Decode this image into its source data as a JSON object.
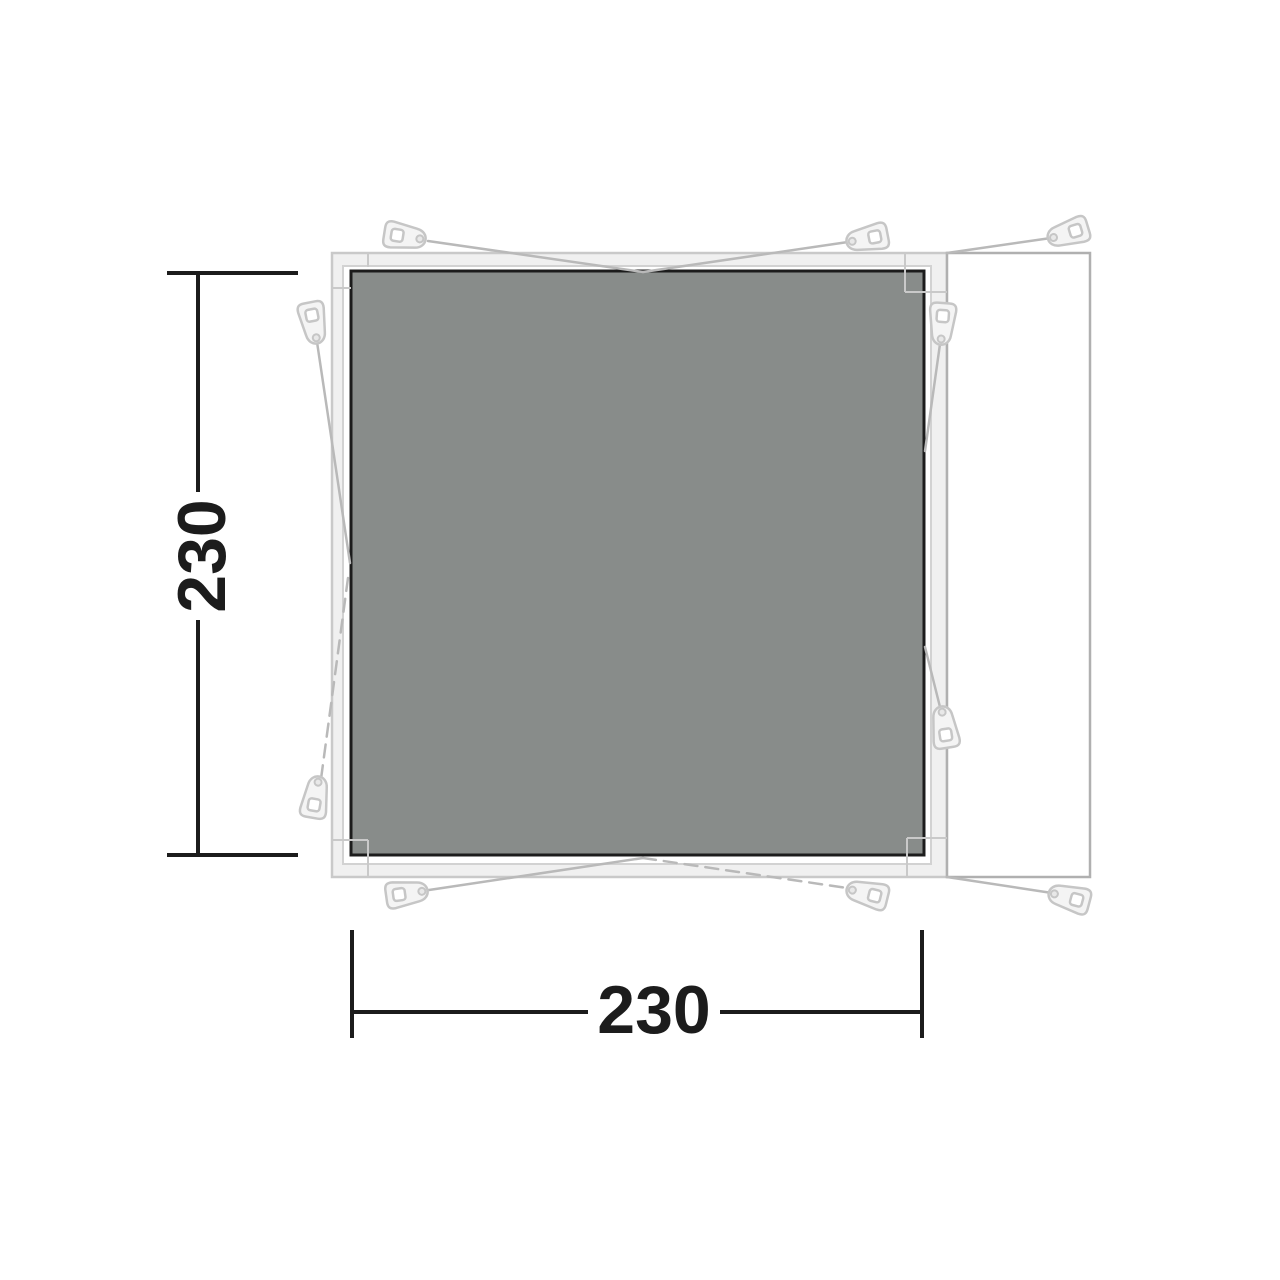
{
  "diagram": {
    "type": "tent-footprint-floorplan",
    "dimensions": {
      "height_label": "230",
      "width_label": "230"
    },
    "colors": {
      "background": "#ffffff",
      "groundsheet_fill": "#888c8a",
      "groundsheet_border": "#1c1c1c",
      "outer_tent_stroke": "#c9c9c9",
      "outer_tent_fill": "#f0f0f0",
      "inner_tent_stroke": "#d2d2d2",
      "inner_tent_fill": "#ffffff",
      "extension_stroke": "#b0b0b0",
      "extension_fill": "#ffffff",
      "guy_line": "#b9b9b9",
      "peg_stroke": "#c6c6c6",
      "peg_fill": "#f4f4f4",
      "dimension_color": "#1c1c1c"
    },
    "shapes": {
      "outer_tent": {
        "x": 332,
        "y": 253,
        "w": 615,
        "h": 624
      },
      "inner_tent": {
        "x": 343,
        "y": 266,
        "w": 588,
        "h": 598
      },
      "groundsheet": {
        "x": 351,
        "y": 271,
        "w": 573,
        "h": 584
      },
      "side_extension": {
        "x": 947,
        "y": 253,
        "w": 143,
        "h": 624
      }
    },
    "seam_lines": [
      [
        368,
        253,
        368,
        267
      ],
      [
        332,
        288,
        351,
        288
      ],
      [
        905,
        253,
        905,
        292
      ],
      [
        905,
        292,
        947,
        292
      ],
      [
        907,
        838,
        907,
        877
      ],
      [
        907,
        838,
        947,
        838
      ],
      [
        332,
        840,
        368,
        840
      ],
      [
        368,
        840,
        368,
        877
      ]
    ],
    "guy_lines": {
      "solid": [
        [
          428,
          241,
          643,
          272
        ],
        [
          643,
          272,
          848,
          242
        ],
        [
          947,
          253,
          1051,
          238
        ],
        [
          317,
          342,
          350,
          563
        ],
        [
          940,
          344,
          925,
          451
        ],
        [
          925,
          647,
          941,
          711
        ],
        [
          643,
          858,
          429,
          890
        ],
        [
          947,
          877,
          1052,
          893
        ]
      ],
      "dashed": [
        [
          348,
          578,
          321,
          779
        ],
        [
          643,
          858,
          847,
          888
        ]
      ]
    },
    "pegs": [
      [
        408,
        237,
        9
      ],
      [
        864,
        239,
        169
      ],
      [
        1065,
        234,
        163
      ],
      [
        314,
        326,
        79
      ],
      [
        316,
        794,
        -80
      ],
      [
        942,
        327,
        94
      ],
      [
        944,
        724,
        -99
      ],
      [
        410,
        893,
        -8
      ],
      [
        864,
        893,
        -166
      ],
      [
        1066,
        897,
        -165
      ]
    ],
    "dimension_annotations": {
      "vertical": {
        "line_x": 198,
        "from_y": 273,
        "to_y": 855,
        "gap": [
          492,
          620
        ],
        "ticks": [
          [
            167,
            273,
            298,
            273
          ],
          [
            167,
            855,
            298,
            855
          ]
        ],
        "label_x": 202,
        "label_y": 556
      },
      "horizontal": {
        "line_y": 1012,
        "from_x": 352,
        "to_x": 922,
        "gap": [
          588,
          720
        ],
        "ticks": [
          [
            352,
            930,
            352,
            1038
          ],
          [
            922,
            930,
            922,
            1038
          ]
        ],
        "label_x": 654,
        "label_y": 1010
      }
    }
  }
}
